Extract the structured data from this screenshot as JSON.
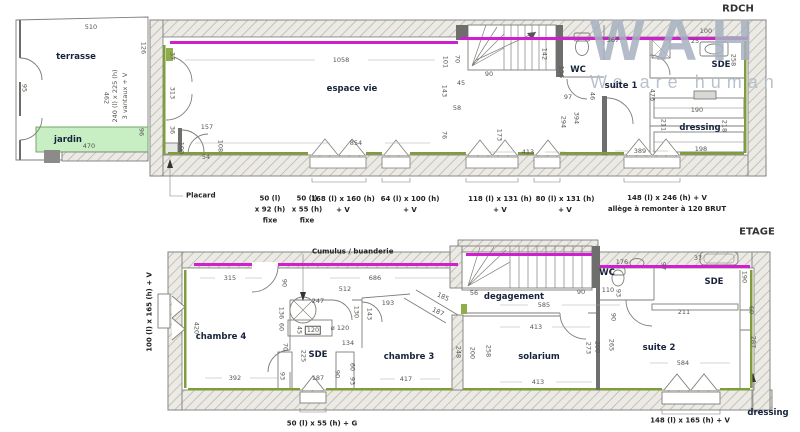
{
  "watermark": {
    "title": "WAH",
    "subtitle": "We are human"
  },
  "colors": {
    "accent_magenta": "#cf1fcf",
    "accent_green": "#7f9d3b",
    "jardin_fill": "#c8eec3",
    "watermark_gray": "#a7b1c0",
    "wall_hatch": "#b9b5ab"
  },
  "rdch": {
    "floor_label": "RDCH",
    "room_labels": [
      {
        "t": "terrasse",
        "x": 76,
        "y": 57
      },
      {
        "t": "jardin",
        "x": 68,
        "y": 140
      },
      {
        "t": "espace vie",
        "x": 352,
        "y": 89
      },
      {
        "t": "WC",
        "x": 578,
        "y": 70
      },
      {
        "t": "suite 1",
        "x": 621,
        "y": 86
      },
      {
        "t": "SDE",
        "x": 721,
        "y": 65
      },
      {
        "t": "dressing",
        "x": 700,
        "y": 128
      }
    ],
    "dim_labels": [
      {
        "t": "510",
        "x": 91,
        "y": 27
      },
      {
        "t": "126",
        "x": 143,
        "y": 48,
        "r": 90
      },
      {
        "t": "462",
        "x": 106,
        "y": 98,
        "r": 90
      },
      {
        "t": "240 (l) x 225 (h)",
        "x": 115,
        "y": 96,
        "r": -90
      },
      {
        "t": "3 vantaux + V",
        "x": 125,
        "y": 96,
        "r": -90
      },
      {
        "t": "95",
        "x": 24,
        "y": 88,
        "r": 90
      },
      {
        "t": "96",
        "x": 141,
        "y": 132,
        "r": 90
      },
      {
        "t": "470",
        "x": 89,
        "y": 146
      },
      {
        "t": "37",
        "x": 172,
        "y": 56,
        "r": 90
      },
      {
        "t": "1058",
        "x": 341,
        "y": 60
      },
      {
        "t": "313",
        "x": 172,
        "y": 93,
        "r": 90
      },
      {
        "t": "157",
        "x": 207,
        "y": 127
      },
      {
        "t": "36",
        "x": 172,
        "y": 130,
        "r": 90
      },
      {
        "t": "100",
        "x": 181,
        "y": 148,
        "r": 90
      },
      {
        "t": "54",
        "x": 206,
        "y": 157
      },
      {
        "t": "108",
        "x": 220,
        "y": 146,
        "r": 90
      },
      {
        "t": "854",
        "x": 356,
        "y": 143
      },
      {
        "t": "101",
        "x": 445,
        "y": 62,
        "r": 90
      },
      {
        "t": "70",
        "x": 457,
        "y": 59,
        "r": 90
      },
      {
        "t": "45",
        "x": 461,
        "y": 83
      },
      {
        "t": "143",
        "x": 444,
        "y": 91,
        "r": 90
      },
      {
        "t": "58",
        "x": 457,
        "y": 108
      },
      {
        "t": "76",
        "x": 444,
        "y": 135,
        "r": 90
      },
      {
        "t": "90",
        "x": 489,
        "y": 74
      },
      {
        "t": "142",
        "x": 544,
        "y": 54,
        "r": 90
      },
      {
        "t": "156",
        "x": 561,
        "y": 72,
        "r": 90
      },
      {
        "t": "97",
        "x": 568,
        "y": 97
      },
      {
        "t": "46",
        "x": 592,
        "y": 96,
        "r": 90
      },
      {
        "t": "294",
        "x": 563,
        "y": 122,
        "r": 90
      },
      {
        "t": "394",
        "x": 576,
        "y": 118,
        "r": 90
      },
      {
        "t": "173",
        "x": 499,
        "y": 135,
        "r": 90
      },
      {
        "t": "413",
        "x": 528,
        "y": 152
      },
      {
        "t": "389",
        "x": 640,
        "y": 151
      },
      {
        "t": "367",
        "x": 613,
        "y": 40
      },
      {
        "t": "100",
        "x": 706,
        "y": 31
      },
      {
        "t": "25",
        "x": 695,
        "y": 41
      },
      {
        "t": "258",
        "x": 733,
        "y": 60,
        "r": 90
      },
      {
        "t": "476",
        "x": 652,
        "y": 95,
        "r": 90
      },
      {
        "t": "190",
        "x": 697,
        "y": 110
      },
      {
        "t": "211",
        "x": 663,
        "y": 125,
        "r": 90
      },
      {
        "t": "218",
        "x": 724,
        "y": 126,
        "r": 90
      },
      {
        "t": "198",
        "x": 701,
        "y": 149
      }
    ],
    "annotations": [
      {
        "lines": [
          "Placard"
        ],
        "x": 186,
        "y": 196,
        "align": "left"
      },
      {
        "lines": [
          "50 (l)",
          "x 92 (h)",
          "fixe"
        ],
        "x": 270,
        "y": 210
      },
      {
        "lines": [
          "50 (l)",
          "x 55 (h)",
          "fixe"
        ],
        "x": 307,
        "y": 210
      },
      {
        "lines": [
          "168 (l) x 160 (h)",
          "+ V"
        ],
        "x": 343,
        "y": 205
      },
      {
        "lines": [
          "64 (l) x 100 (h)",
          "+ V"
        ],
        "x": 410,
        "y": 205
      },
      {
        "lines": [
          "118 (l) x 131 (h)",
          "+ V"
        ],
        "x": 500,
        "y": 205
      },
      {
        "lines": [
          "80 (l) x 131 (h)",
          "+ V"
        ],
        "x": 565,
        "y": 205
      },
      {
        "lines": [
          "148 (l) x 246 (h) + V",
          "allège à remonter à 120 BRUT"
        ],
        "x": 667,
        "y": 204
      }
    ]
  },
  "etage": {
    "floor_label": "ETAGE",
    "room_labels": [
      {
        "t": "chambre 4",
        "x": 221,
        "y": 337
      },
      {
        "t": "SDE",
        "x": 318,
        "y": 355
      },
      {
        "t": "chambre 3",
        "x": 409,
        "y": 357
      },
      {
        "t": "degagement",
        "x": 514,
        "y": 297
      },
      {
        "t": "solarium",
        "x": 539,
        "y": 357
      },
      {
        "t": "WC",
        "x": 607,
        "y": 273
      },
      {
        "t": "SDE",
        "x": 714,
        "y": 282
      },
      {
        "t": "suite 2",
        "x": 659,
        "y": 348
      },
      {
        "t": "dressing",
        "x": 768,
        "y": 413
      }
    ],
    "dim_labels": [
      {
        "t": "315",
        "x": 230,
        "y": 278
      },
      {
        "t": "90",
        "x": 284,
        "y": 283,
        "r": 90
      },
      {
        "t": "686",
        "x": 375,
        "y": 278
      },
      {
        "t": "512",
        "x": 345,
        "y": 289
      },
      {
        "t": "247",
        "x": 318,
        "y": 301
      },
      {
        "t": "193",
        "x": 388,
        "y": 303
      },
      {
        "t": "136",
        "x": 281,
        "y": 313,
        "r": 90
      },
      {
        "t": "60",
        "x": 281,
        "y": 327,
        "r": 90
      },
      {
        "t": "130",
        "x": 356,
        "y": 312,
        "r": 90
      },
      {
        "t": "143",
        "x": 369,
        "y": 314,
        "r": 90
      },
      {
        "t": "45",
        "x": 299,
        "y": 330,
        "r": 90
      },
      {
        "t": "120",
        "x": 313,
        "y": 330,
        "box": true
      },
      {
        "t": "ø 120",
        "x": 340,
        "y": 328
      },
      {
        "t": "134",
        "x": 348,
        "y": 343
      },
      {
        "t": "70",
        "x": 285,
        "y": 347,
        "r": 90
      },
      {
        "t": "225",
        "x": 303,
        "y": 356,
        "r": 90
      },
      {
        "t": "93",
        "x": 282,
        "y": 376,
        "r": 90
      },
      {
        "t": "187",
        "x": 318,
        "y": 378
      },
      {
        "t": "90",
        "x": 337,
        "y": 374,
        "r": 90
      },
      {
        "t": "60",
        "x": 352,
        "y": 367,
        "r": 90
      },
      {
        "t": "93",
        "x": 352,
        "y": 381,
        "r": 90
      },
      {
        "t": "392",
        "x": 235,
        "y": 378
      },
      {
        "t": "420",
        "x": 196,
        "y": 328,
        "r": 90
      },
      {
        "t": "417",
        "x": 406,
        "y": 379
      },
      {
        "t": "248",
        "x": 458,
        "y": 352,
        "r": 90
      },
      {
        "t": "200",
        "x": 472,
        "y": 353,
        "r": 90
      },
      {
        "t": "258",
        "x": 488,
        "y": 351,
        "r": 90
      },
      {
        "t": "185",
        "x": 443,
        "y": 297,
        "r": 25
      },
      {
        "t": "187",
        "x": 438,
        "y": 312,
        "r": 25
      },
      {
        "t": "56",
        "x": 474,
        "y": 293
      },
      {
        "t": "585",
        "x": 544,
        "y": 305
      },
      {
        "t": "90",
        "x": 581,
        "y": 292
      },
      {
        "t": "110",
        "x": 608,
        "y": 290
      },
      {
        "t": "413",
        "x": 536,
        "y": 327
      },
      {
        "t": "413",
        "x": 538,
        "y": 382
      },
      {
        "t": "273",
        "x": 588,
        "y": 348,
        "r": 90
      },
      {
        "t": "200",
        "x": 597,
        "y": 347,
        "r": 90
      },
      {
        "t": "176",
        "x": 622,
        "y": 262
      },
      {
        "t": "93",
        "x": 618,
        "y": 293,
        "r": 90
      },
      {
        "t": "97",
        "x": 663,
        "y": 266,
        "r": 90
      },
      {
        "t": "37",
        "x": 698,
        "y": 258
      },
      {
        "t": "190",
        "x": 744,
        "y": 277,
        "r": 90
      },
      {
        "t": "211",
        "x": 684,
        "y": 312
      },
      {
        "t": "60",
        "x": 751,
        "y": 310,
        "r": 90
      },
      {
        "t": "90",
        "x": 613,
        "y": 317,
        "r": 90
      },
      {
        "t": "265",
        "x": 611,
        "y": 345,
        "r": 90
      },
      {
        "t": "584",
        "x": 683,
        "y": 363
      },
      {
        "t": "287",
        "x": 753,
        "y": 342,
        "r": 90
      }
    ],
    "annotations": [
      {
        "lines": [
          "Cumulus / buanderie"
        ],
        "x": 312,
        "y": 252,
        "align": "left"
      },
      {
        "lines": [
          "100 (l) x 165 (h) + V"
        ],
        "x": 150,
        "y": 312,
        "r": -90
      },
      {
        "lines": [
          "50 (l) x 55 (h) + G"
        ],
        "x": 322,
        "y": 424
      },
      {
        "lines": [
          "148 (l) x 165 (h) + V"
        ],
        "x": 690,
        "y": 421
      }
    ]
  }
}
